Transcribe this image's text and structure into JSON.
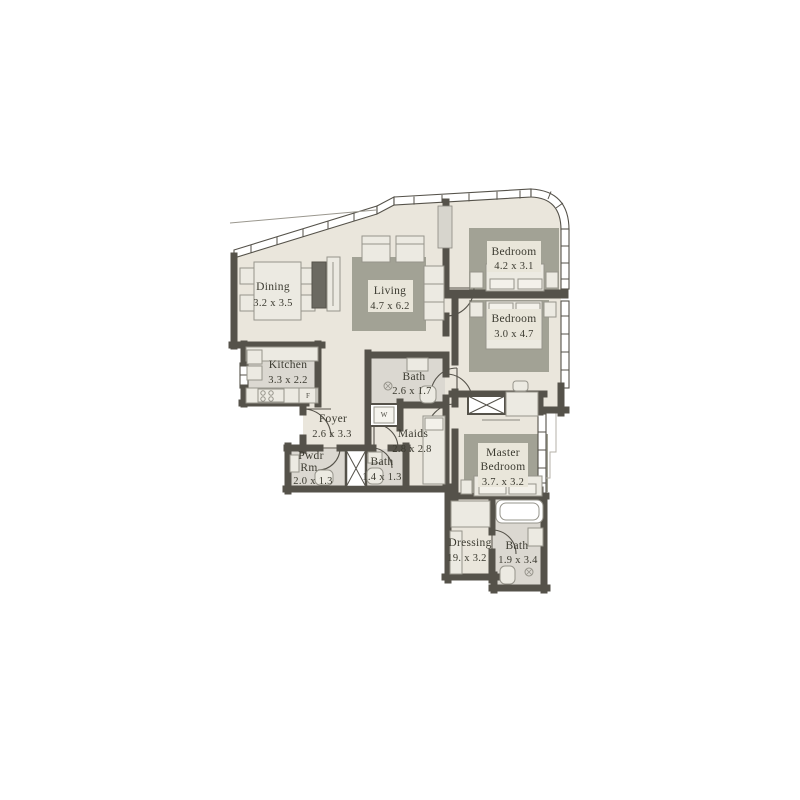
{
  "plan": {
    "type": "apartment-floor-plan",
    "colors": {
      "floor": "#eae6dc",
      "tile": "#dbd8d1",
      "wall": "#55524a",
      "rug": "#a2a295",
      "furniture": "#eceae2",
      "furniture_stroke": "#96948b",
      "dark_cabinet": "#6b6961",
      "label_patch": "#e9e6da",
      "text": "#3b3a30"
    },
    "rooms": [
      {
        "id": "dining",
        "name_lines": [
          "Dining"
        ],
        "dims": "3.2 x 3.5"
      },
      {
        "id": "living",
        "name_lines": [
          "Living"
        ],
        "dims": "4.7 x 6.2"
      },
      {
        "id": "bedroom-1",
        "name_lines": [
          "Bedroom"
        ],
        "dims": "4.2 x 3.1"
      },
      {
        "id": "bedroom-2",
        "name_lines": [
          "Bedroom"
        ],
        "dims": "3.0 x 4.7"
      },
      {
        "id": "kitchen",
        "name_lines": [
          "Kitchen"
        ],
        "dims": "3.3 x 2.2"
      },
      {
        "id": "bath-guest",
        "name_lines": [
          "Bath"
        ],
        "dims": "2.6 x 1.7"
      },
      {
        "id": "foyer",
        "name_lines": [
          "Foyer"
        ],
        "dims": "2.6 x 3.3"
      },
      {
        "id": "maids",
        "name_lines": [
          "Maids"
        ],
        "dims": "2.8 x 2.8"
      },
      {
        "id": "powder-room",
        "name_lines": [
          "Pwdr",
          "Rm"
        ],
        "dims": "2.0 x 1.3"
      },
      {
        "id": "bath-small",
        "name_lines": [
          "Bath"
        ],
        "dims": "1.4 x 1.3"
      },
      {
        "id": "master-bedroom",
        "name_lines": [
          "Master",
          "Bedroom"
        ],
        "dims": "3.7. x 3.2"
      },
      {
        "id": "dressing",
        "name_lines": [
          "Dressing"
        ],
        "dims": "19. x 3.2"
      },
      {
        "id": "bath-master",
        "name_lines": [
          "Bath"
        ],
        "dims": "1.9 x 3.4"
      }
    ],
    "appliance_labels": {
      "washer": "W",
      "fridge": "F"
    }
  }
}
